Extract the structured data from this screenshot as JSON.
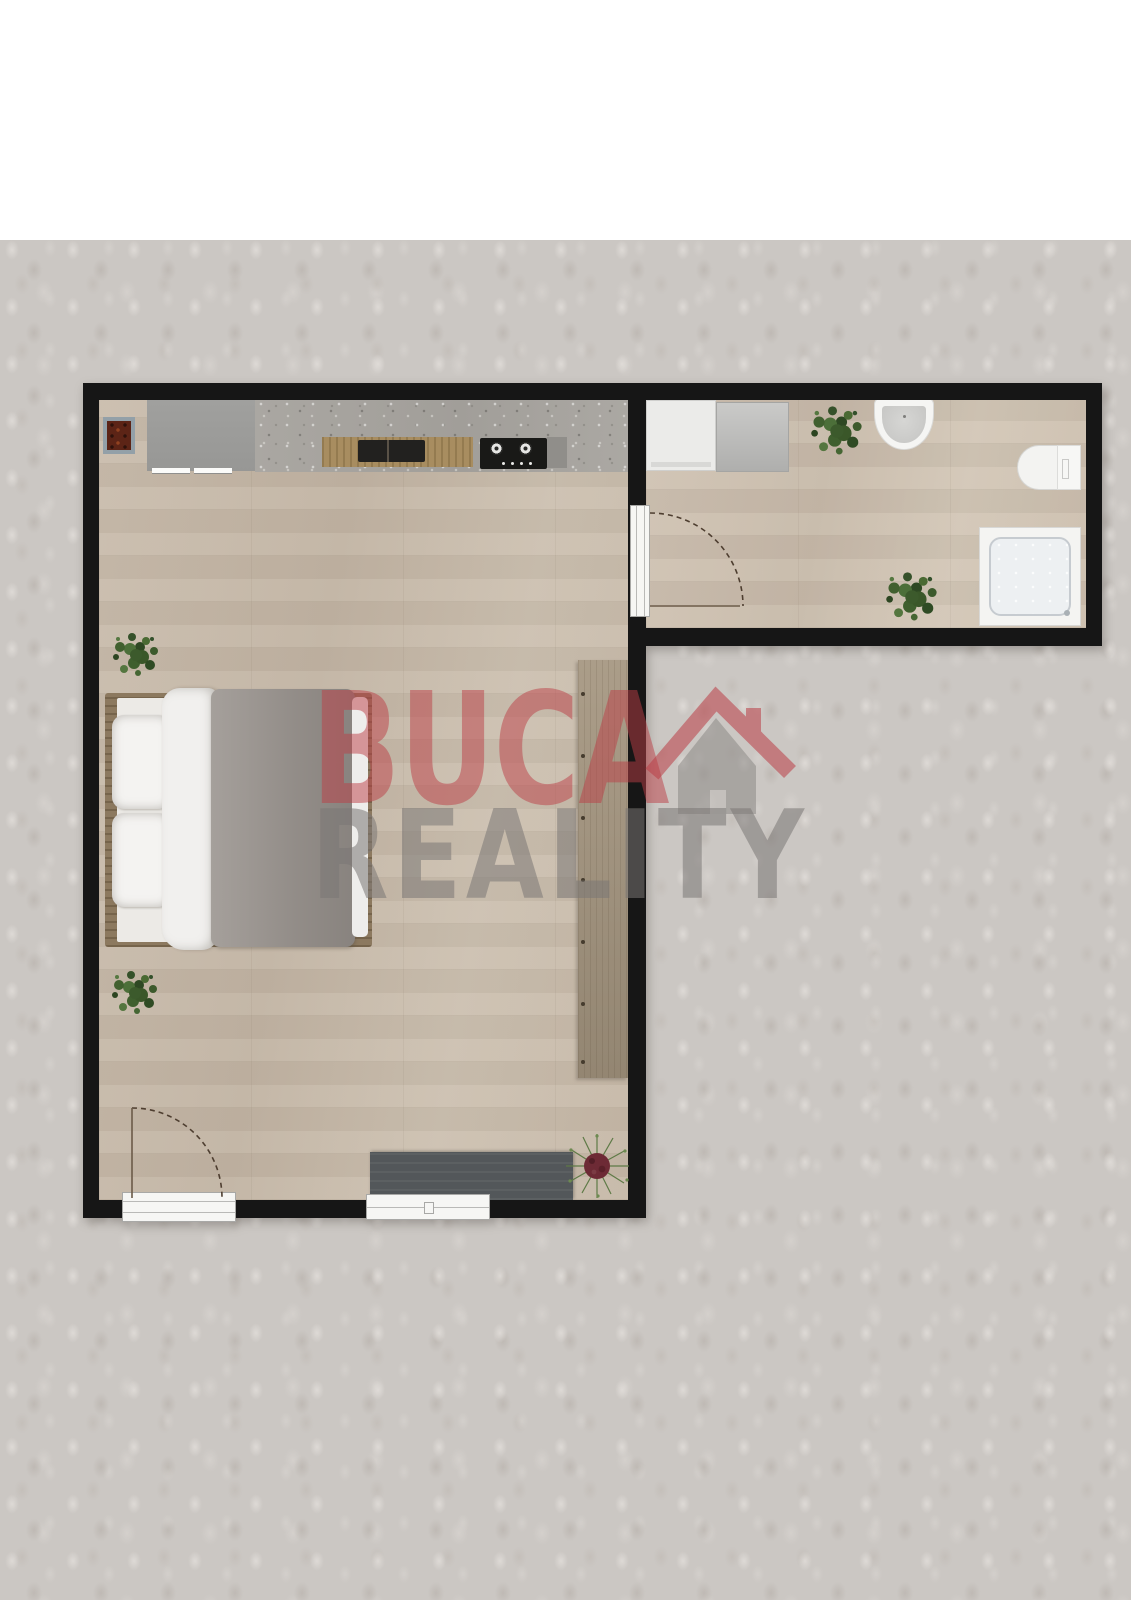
{
  "watermark": {
    "brand_line1": "BUCA",
    "brand_line2": "REALITY",
    "icon": "house-icon",
    "line1_color": "#bb3e46",
    "line2_color": "#7a7774"
  },
  "colors": {
    "top_band": "#ffffff",
    "background_texture": "#cbc7c3",
    "walls": "#161616",
    "wood_floor": "#c6b8a8",
    "kitchen_floor_concrete": "#a7a49f",
    "counter_wood": "#a88d60",
    "cooktop": "#191917",
    "tv_stand": "#53575a",
    "duvet": "#9b9590",
    "wardrobe": "#a4957f",
    "plant_green": "#3c5a2c",
    "rug_red": "#5c2416"
  },
  "floorplan": {
    "type": "apartment-top-view",
    "rooms": [
      {
        "name": "living-room-with-kitchenette",
        "items": [
          "rug",
          "refrigerator",
          "kitchen-counter-with-sink",
          "cooktop",
          "double-bed",
          "pillows",
          "duvet",
          "potted-plant-upper",
          "potted-plant-lower",
          "wardrobe",
          "tv-stand",
          "flowering-plant",
          "entry-door-with-swing",
          "window"
        ]
      },
      {
        "name": "bathroom",
        "items": [
          "washing-machine",
          "cabinet",
          "potted-plant-top",
          "wash-basin",
          "toilet",
          "shower",
          "potted-plant-bottom",
          "interior-door-with-swing"
        ]
      }
    ]
  }
}
